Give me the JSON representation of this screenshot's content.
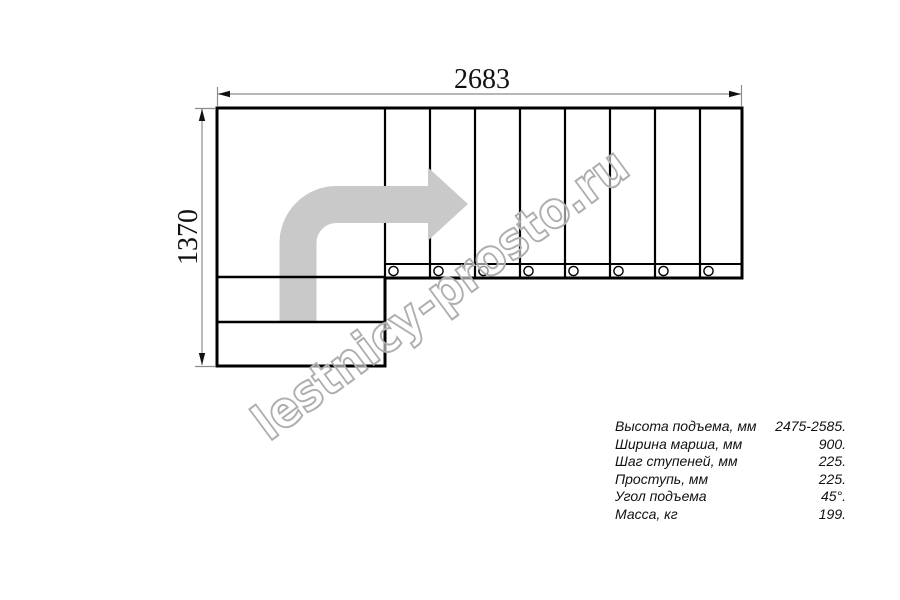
{
  "drawing": {
    "title": "stair-plan-top-view",
    "width_dimension_label": "2683",
    "height_dimension_label": "1370",
    "watermark": "lestnicy-prosto.ru",
    "treads_count": 8,
    "fastener_holes_count": 8,
    "colors": {
      "outline": "#000000",
      "dimension_line": "#8c8c8c",
      "direction_arrow": "#c9c9c9",
      "watermark_outline": "#aeaeae"
    }
  },
  "specs": {
    "rows": [
      {
        "label": "Высота подъема, мм",
        "value": "2475-2585."
      },
      {
        "label": "Ширина марша, мм",
        "value": "900."
      },
      {
        "label": "Шаг ступеней, мм",
        "value": "225."
      },
      {
        "label": "Проступь, мм",
        "value": "225."
      },
      {
        "label": "Угол подъема",
        "value": "45°."
      },
      {
        "label": "Масса, кг",
        "value": "199."
      }
    ]
  }
}
